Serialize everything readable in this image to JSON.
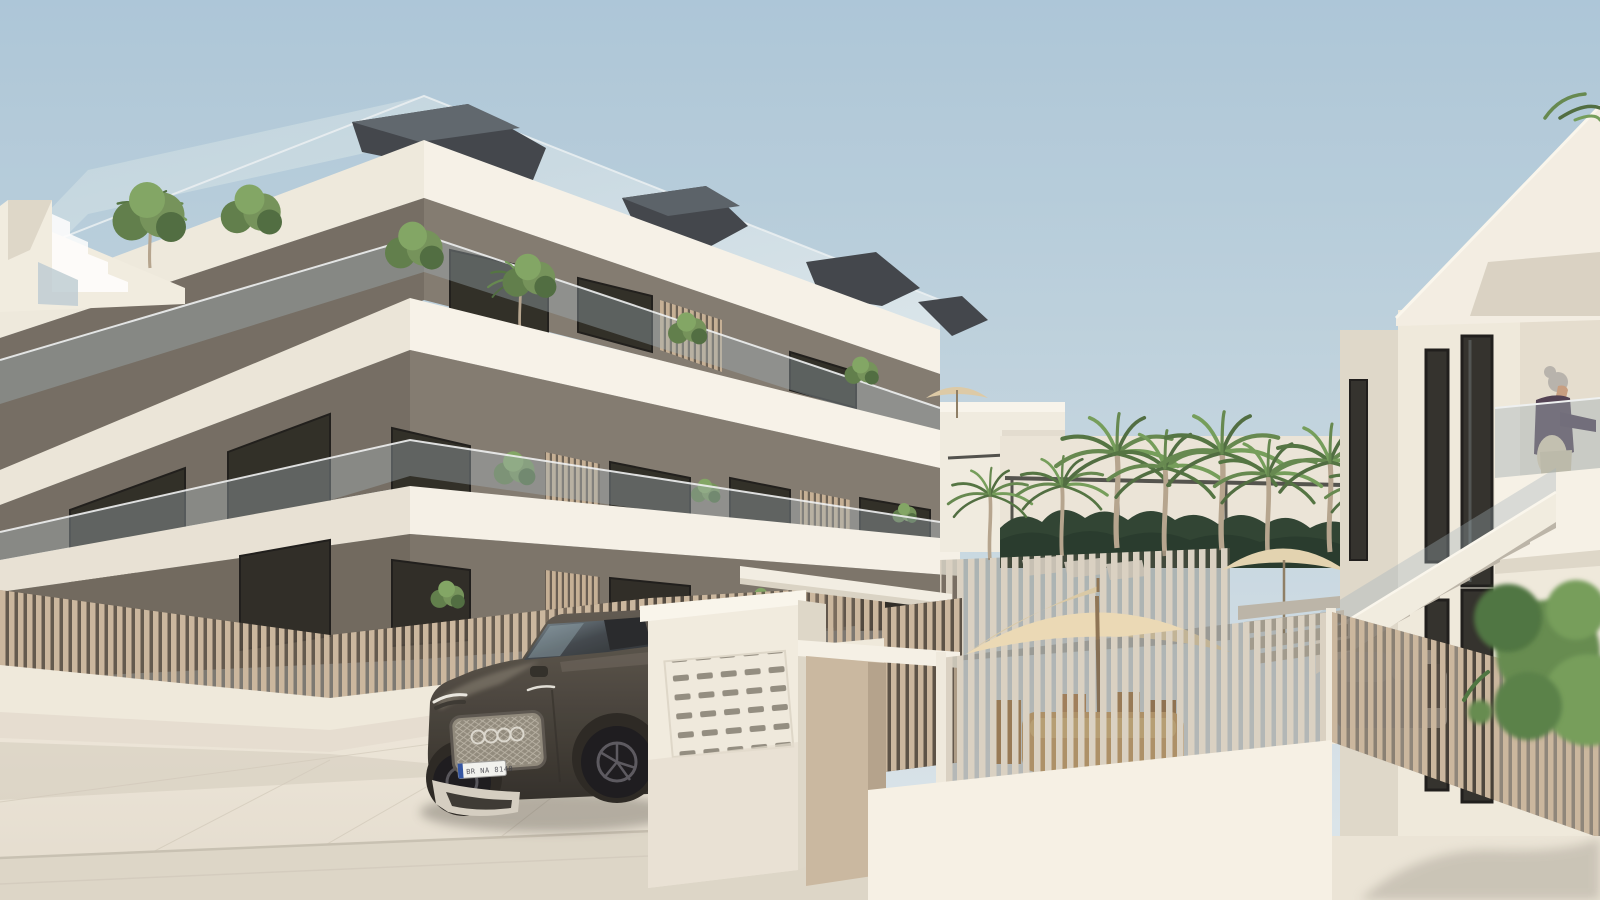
{
  "scene": {
    "title": "New-build apartment complex — exterior 3D render with courtyard, palm trees and parked SUV",
    "license_plate": "BR NA 8140",
    "palette": {
      "sky_top": "#a9c5d8",
      "sky_bottom": "#dde7ec",
      "white_sunlit": "#f4f0e6",
      "white_bright": "#faf7ee",
      "white_shade": "#ddd6c8",
      "slab_underside": "#c9c2b3",
      "wall_taupe": "#7e766c",
      "wall_taupe_dark": "#6b6459",
      "window_dark": "#2b2a25",
      "wood_slat": "#c9b59b",
      "glass_tint": "#a8b8bf",
      "hedge_green": "#273d2c",
      "palm_green": "#5f8449",
      "car_body": "#423d36",
      "pavement": "#e9e3d7",
      "road": "#dcd5c7",
      "umbrella": "#e9dab6",
      "roof_sail": "#3a3f45"
    },
    "objects": [
      "sky",
      "apartment-building",
      "roof-sails",
      "rooftop-terrace",
      "glass-balustrades",
      "balcony-plants",
      "timber-privacy-screens",
      "street-fence",
      "mailbox-wall",
      "entrance-pergola",
      "audi-suv",
      "courtyard",
      "palm-trees",
      "garden-hedge",
      "sun-loungers",
      "patio-umbrellas",
      "outdoor-dining-set",
      "right-building",
      "external-staircase",
      "woman-on-balcony",
      "outdoor-sofa",
      "street-pavement",
      "green-tree"
    ]
  }
}
